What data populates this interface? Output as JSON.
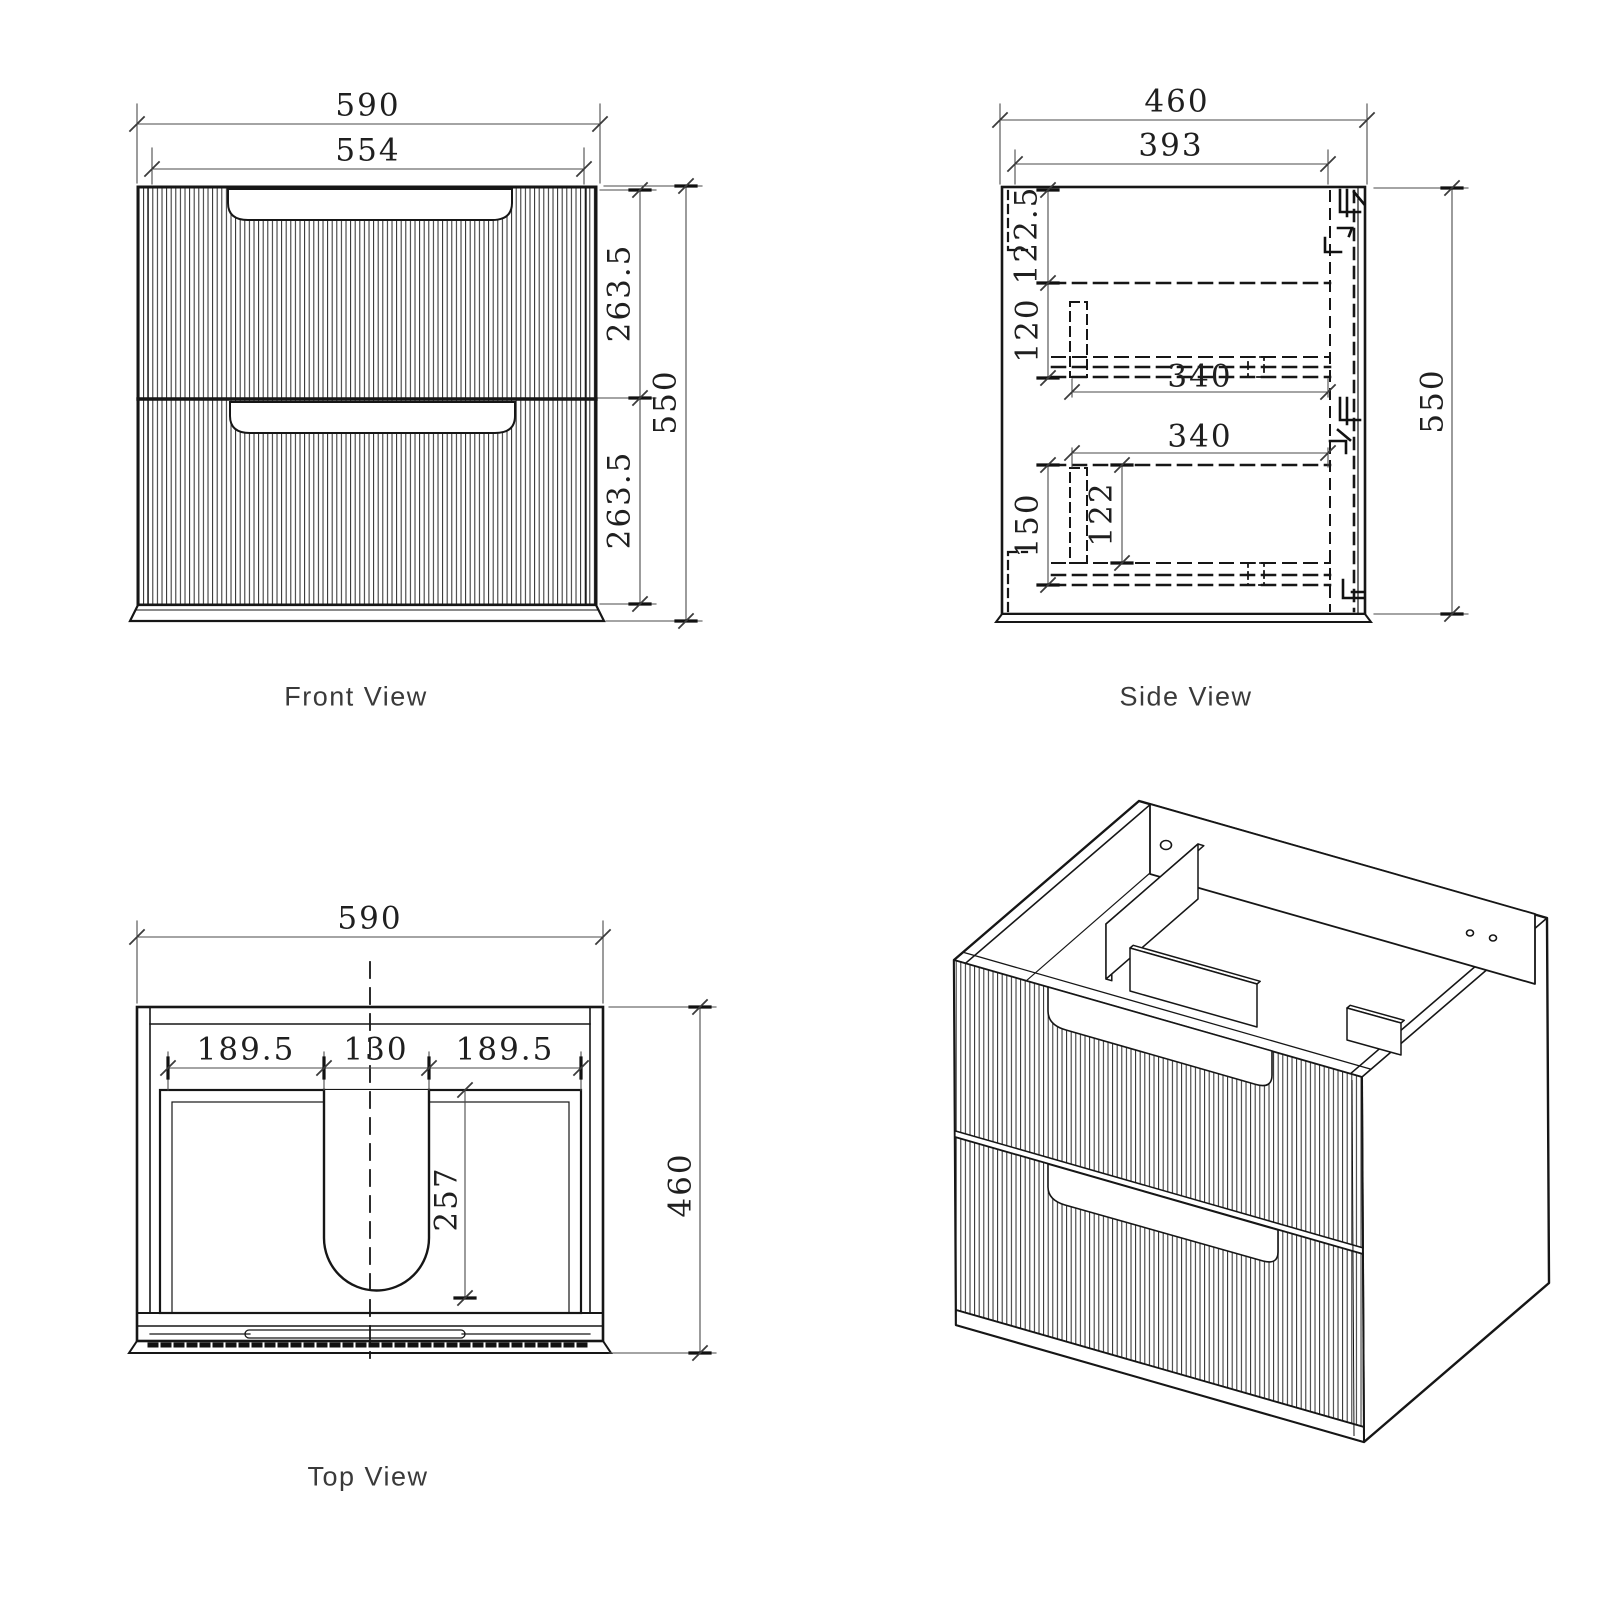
{
  "page": {
    "background": "#ffffff"
  },
  "colors": {
    "object_line": "#161616",
    "dimension_line": "#4a4a4a",
    "dimension_text": "#1f1f1f",
    "label_text": "#3a3a3a"
  },
  "views": {
    "front": {
      "label": "Front View",
      "dims": {
        "overall_width": "590",
        "drawer_width": "554",
        "upper_drawer_height": "263.5",
        "overall_height": "550",
        "lower_drawer_height": "263.5"
      }
    },
    "side": {
      "label": "Side View",
      "dims": {
        "overall_depth": "460",
        "internal_depth": "393",
        "top_clearance": "122.5",
        "drawer1_internal": "120",
        "drawer1_runner": "340",
        "drawer2_runner": "340",
        "drawer2_clearance": "150",
        "drawer2_internal": "122",
        "overall_height": "550"
      }
    },
    "top": {
      "label": "Top View",
      "dims": {
        "overall_width": "590",
        "left_offset": "189.5",
        "cutout_width": "130",
        "right_offset": "189.5",
        "cutout_depth": "257",
        "overall_depth": "460"
      }
    }
  }
}
